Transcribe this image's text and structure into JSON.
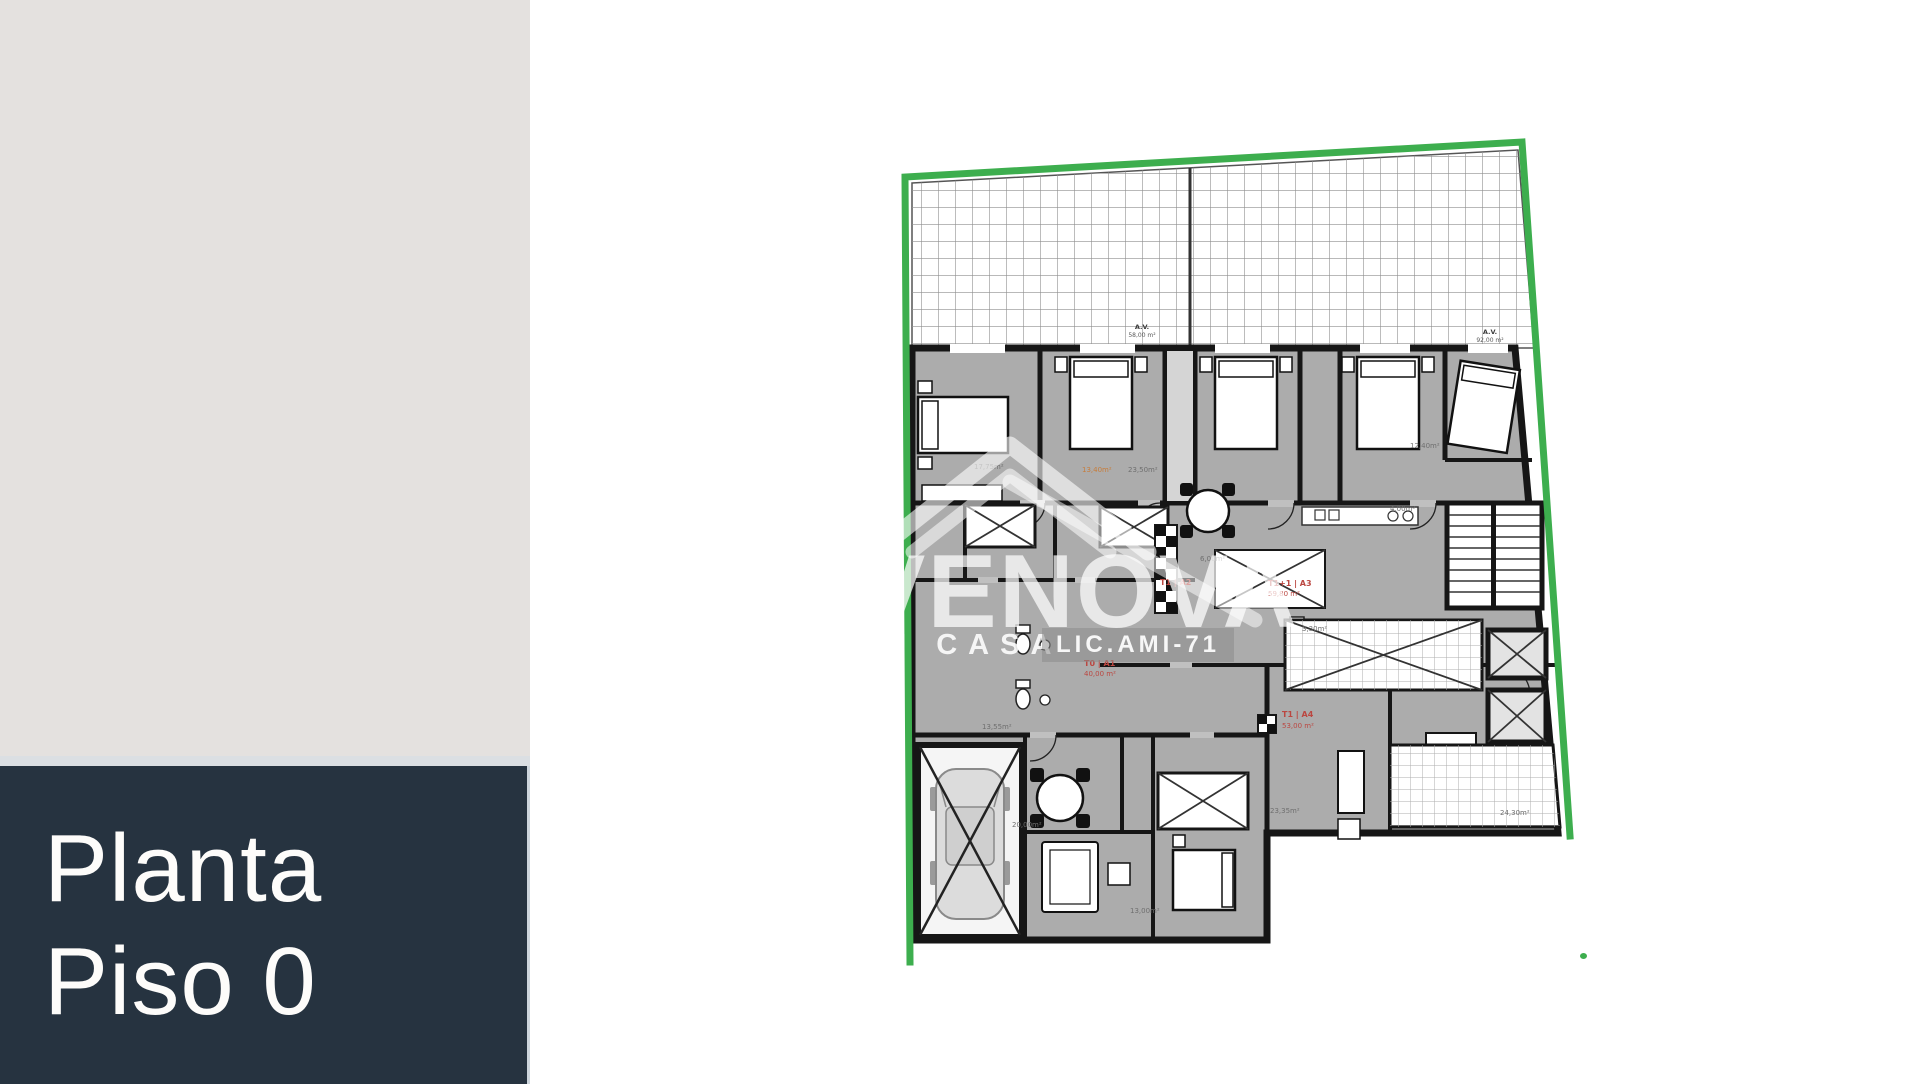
{
  "sidebar": {
    "title_line1": "Planta",
    "title_line2": "Piso 0",
    "colors": {
      "panel_top": "#e4e1df",
      "divider": "#dbdfe3",
      "panel_bottom": "#263340",
      "title_text": "#fdfcfa"
    }
  },
  "plan": {
    "colors": {
      "lot_boundary_green": "#3dae4e",
      "walls": "#161616",
      "floor_gray": "#acacac",
      "unit_label_red": "#bb4741",
      "room_label_gray": "#6f6f6f"
    },
    "terraces": [
      {
        "label": "A.V.",
        "area": "58,00 m²"
      },
      {
        "label": "A.V.",
        "area": "92,00 m²"
      }
    ],
    "units": [
      {
        "id": "T1 | A2",
        "area": ""
      },
      {
        "id": "T1+1 | A3",
        "area": "59,80 m²"
      },
      {
        "id": "T0 | A1",
        "area": "40,00 m²"
      },
      {
        "id": "T1 | A4",
        "area": "53,00 m²"
      }
    ],
    "room_labels": [
      "17,75m²",
      "13,40m²",
      "23,50m²",
      "12,40m²",
      "4,00m²",
      "6,00m²",
      "13,55m²",
      "20,00m²",
      "23,35m²",
      "13,00m²",
      "24,30m²",
      "3,30m²"
    ]
  },
  "watermark": {
    "brand": "VENOVA",
    "tagline": "M CASA",
    "license": "LIC.AMI-71"
  }
}
